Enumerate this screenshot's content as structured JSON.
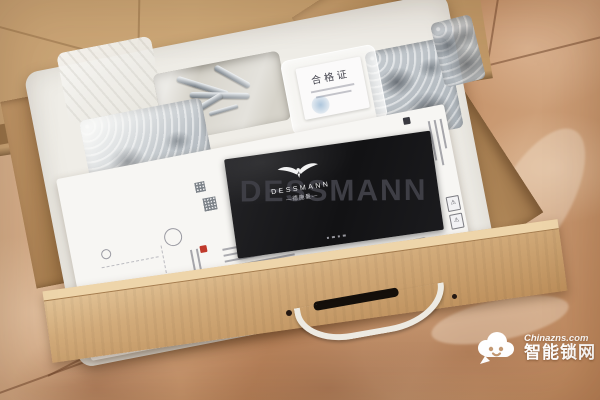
{
  "brand_panel": {
    "watermark_text": "DESSMANN",
    "logo_text": "DESSMANN",
    "logo_text_cn": "—德施曼—"
  },
  "certificate_card": {
    "title": "合格证"
  },
  "side_label": {
    "warning_glyph": "⚠"
  },
  "site_watermark": {
    "site": "Chinazns.com",
    "name_cn": "智能锁网"
  },
  "colors": {
    "marble_base": "#c79a74",
    "cardboard": "#c9a173",
    "foam_white": "#efede7",
    "panel_black": "#17171a",
    "stamp_red": "#c0392b",
    "certificate_stamp_blue": "#6f9cc4",
    "watermark_white": "#ffffff"
  }
}
